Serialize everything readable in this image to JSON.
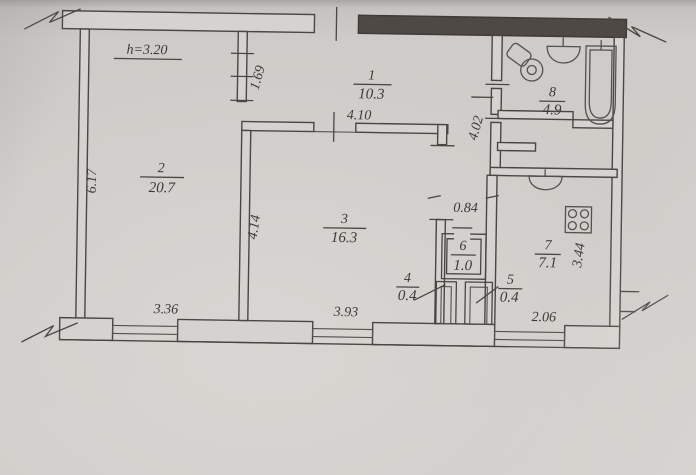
{
  "plan": {
    "height_note": "h=3.20",
    "rooms": [
      {
        "number": "1",
        "area": "10.3"
      },
      {
        "number": "2",
        "area": "20.7"
      },
      {
        "number": "3",
        "area": "16.3"
      },
      {
        "number": "4",
        "area": "0.4"
      },
      {
        "number": "5",
        "area": "0.4"
      },
      {
        "number": "6",
        "area": "1.0"
      },
      {
        "number": "7",
        "area": "7.1"
      },
      {
        "number": "8",
        "area": "4.9"
      }
    ],
    "dimensions": {
      "left_wall": "6.17",
      "partition_1_2": "1.69",
      "room3_top": "4.10",
      "room3_left": "4.14",
      "corridor": "4.02",
      "corridor_width": "0.84",
      "kitchen_right": "3.44",
      "bottom_left": "3.36",
      "bottom_center": "3.93",
      "bottom_right": "2.06"
    },
    "fixtures": {
      "bathroom": [
        "toilet-icon",
        "sink-icon",
        "bathtub-icon"
      ],
      "kitchen": [
        "kitchen-sink-icon",
        "stove-icon"
      ]
    },
    "colors": {
      "paper": "#cfcbc8",
      "ink": "#4a4643",
      "dark_wall": "#4e4945"
    }
  }
}
